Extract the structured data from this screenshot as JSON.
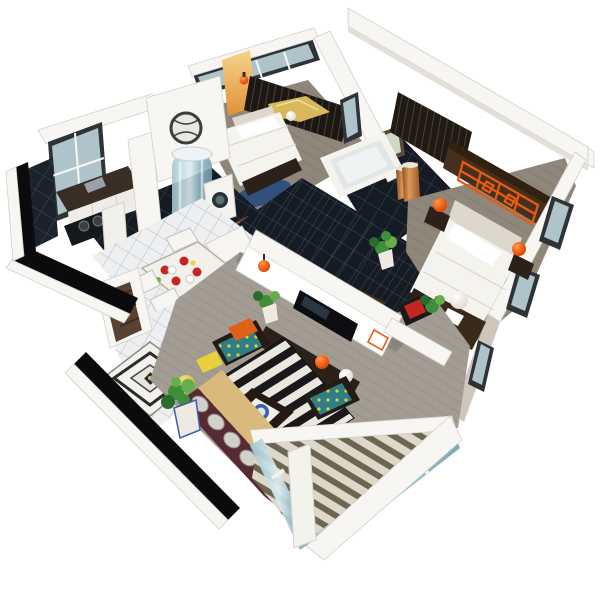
{
  "scene": {
    "title": "3D isometric cutaway render of a furnished three-bedroom apartment floor plan, Chinese modern style, on a white background",
    "view": "axonometric cutaway from above",
    "background": "#ffffff"
  },
  "palette": {
    "background": "#ffffff",
    "wall": "#f7f6f3",
    "wallShade": "#e3e0da",
    "capLine": "#d3d0c9",
    "beige": "#cfc5ba",
    "cut": "#0b0b0d",
    "darkTile": "#151b24",
    "woodLiving": "#a29c92",
    "woodBedroom": "#8f8779",
    "whiteTile": "#edeff1",
    "tileLine": "#c9ced3",
    "accentWood": "#46301d",
    "lattice": "#e85c12",
    "lantern": "#e8470d",
    "bedWhite": "#f5f3ee",
    "bedShadow": "#ddd8cd",
    "sofa": "#572a34",
    "sofaCushion": "#d2d0c9",
    "chaise": "#d9b97c",
    "rugBlack": "#1a181a",
    "rugWhite": "#eae7e1",
    "teal": "#2e7e86",
    "dotYellow": "#e9c93e",
    "orange": "#e06018",
    "yellow": "#e8d23c",
    "bluePlate": "#3b5fa8",
    "redDish": "#c42525",
    "plantGreen": "#3f8f3a",
    "plantLight": "#66ad4c",
    "plantDark": "#2b6b2e",
    "copper": "#b06a35",
    "copperHi": "#dd9a5a",
    "glass": "#bcd8da",
    "frame": "#2e3338",
    "glassPane": "#aec3ca",
    "door": "#5a4233",
    "darkWood": "#2c2118",
    "deckDark": "#55503f",
    "gold": "#d8b85a",
    "water": "#7fb6c9"
  },
  "rooms": [
    {
      "name": "kitchen",
      "floor": "dark glossy tile",
      "items": [
        "window",
        "dark stone counter with sink",
        "two-burner cooktop",
        "white cabinet",
        "dark tile backsplash"
      ]
    },
    {
      "name": "laundry-bathroom",
      "floor": "dark glossy tile",
      "items": [
        "cylindrical glass shower",
        "washing machine",
        "copper pail",
        "wood slat drying deck"
      ]
    },
    {
      "name": "small-bedroom",
      "floor": "grey wood",
      "items": [
        "double bed with white duvet",
        "dark wardrobe",
        "gold dragon-boat decor",
        "wall lantern",
        "amber accent wall",
        "windows",
        "blue rug"
      ]
    },
    {
      "name": "main-bathroom",
      "floor": "dark tile",
      "items": [
        "bathtub",
        "window",
        "framed picture",
        "copper pail"
      ]
    },
    {
      "name": "hallway",
      "floor": "black glossy tile with white grout",
      "items": [
        "copper floor vase",
        "round moon-gate lattice window"
      ]
    },
    {
      "name": "master-bedroom",
      "floor": "grey wood",
      "items": [
        "double bed",
        "dark walnut headboard wall with orange carved lattice panel",
        "two orange lanterns",
        "open closet",
        "blue patterned rug",
        "foot bench",
        "vanity desk",
        "white globe lamp",
        "armchairs with red cushions",
        "potted plant",
        "side windows"
      ]
    },
    {
      "name": "study",
      "floor": "grey wood",
      "items": [
        "writing desk",
        "black chair",
        "red lounge chair",
        "orange lantern",
        "white globe lamp",
        "potted plants"
      ]
    },
    {
      "name": "dining-area",
      "floor": "white tile",
      "items": [
        "dining table",
        "white chairs",
        "red dinnerware",
        "white sideboard",
        "globe floor lamp"
      ]
    },
    {
      "name": "foyer",
      "floor": "white tile",
      "items": [
        "open brown entry door",
        "diamond medallion floor tile"
      ]
    },
    {
      "name": "living-room",
      "floor": "grey wood plank",
      "items": [
        "white tv partition wall",
        "flat tv",
        "hanging lantern",
        "long media console",
        "orange table lamp",
        "white globe lamp",
        "black and white striped rug",
        "maroon corner sofa with patterned cushions",
        "tan chaise",
        "dark coffee table with blue porcelain plate",
        "armchair with orange cushion",
        "armchairs with teal yellow-dot cushions",
        "yellow cushion",
        "yellow globe lamp",
        "potted plants"
      ]
    },
    {
      "name": "balcony",
      "floor": "slatted deck",
      "items": [
        "glass curtain wall",
        "white corner pillar",
        "white parapet beams"
      ]
    }
  ]
}
